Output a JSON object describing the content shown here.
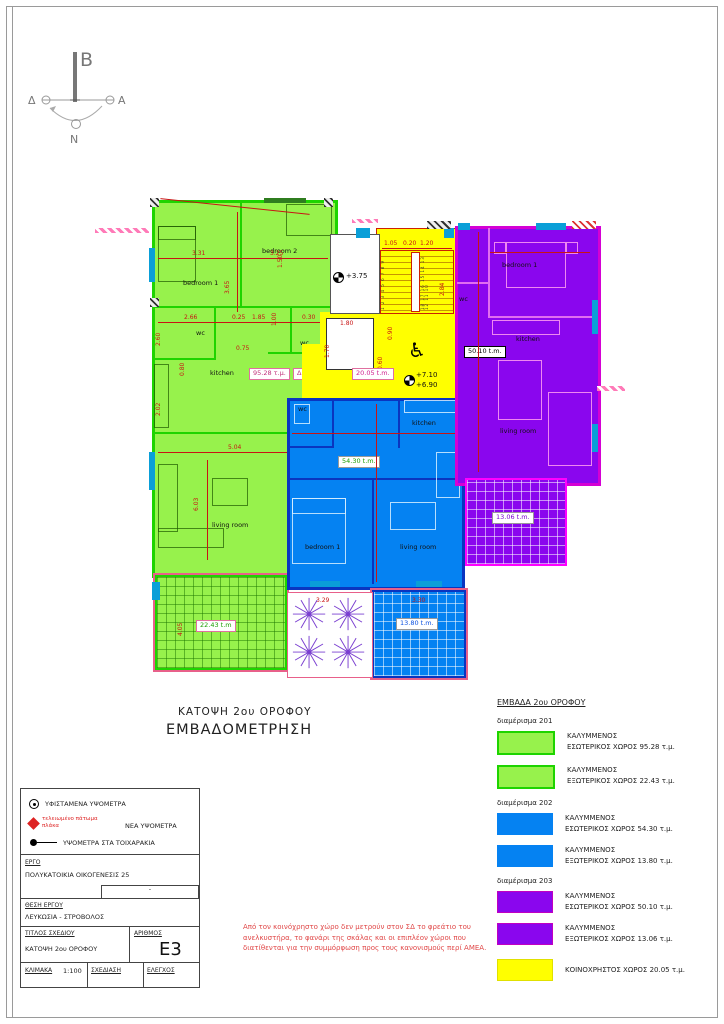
{
  "compass": {
    "north": "B",
    "east": "A",
    "west": "Δ",
    "south": "N"
  },
  "titles": {
    "line1": "ΚΑΤΟΨΗ  2ου ΟΡΟΦΟΥ",
    "line2": "ΕΜΒΑΔΟΜΕΤΡΗΣΗ"
  },
  "icons": {
    "wheelchair": "♿"
  },
  "plan": {
    "apt201": {
      "tag": "ΔΙΑΜ 201",
      "area_box": "95.28 τ.μ.",
      "balcony": "22.43 t.m",
      "bedroom1": "bedroom 1",
      "bedroom2": "bedroom 2",
      "wc1": "wc",
      "wc2": "wc",
      "kitchen": "kitchen",
      "living": "living room"
    },
    "apt202": {
      "area_box": "54.30 t.m.",
      "balcony": "13.80 t.m.",
      "wc": "wc",
      "kitchen": "kitchen",
      "bedroom1": "bedroom 1",
      "living": "living room"
    },
    "apt203": {
      "area_box": "50.10 t.m.",
      "balcony": "13.06 t.m.",
      "wc": "wc",
      "kitchen": "kitchen",
      "bedroom1": "bedroom 1",
      "living": "living room"
    },
    "common": {
      "area_box": "20.05 t.m.",
      "level_existing": "+3.75",
      "level_new1": "+7.10",
      "level_new2": "+6.90",
      "stairs_left": "1 2 3 4 5 6 7 8 9",
      "stairs_right": "18 17 16 15 14 13 12 11 10"
    },
    "dims": {
      "d1": "3.31",
      "d2": "3.25",
      "d3": "3.65",
      "d4": "1.50",
      "d5": "2.66",
      "d6": "0.25",
      "d7": "1.85",
      "d8": "1.00",
      "d9": "0.30",
      "d10": "0.80",
      "d11": "5.04",
      "d12": "6.03",
      "d13": "4.05",
      "d14": "2.02",
      "d15": "2.60",
      "d16": "1.05",
      "d17": "0.20",
      "d18": "1.20",
      "d19": "2.84",
      "d20": "0.90",
      "d21": "0.60",
      "d22": "1.80",
      "d23": "1.70",
      "d24": "3.29",
      "d25": "3.30",
      "d26": "0.75"
    }
  },
  "legend": {
    "header": "ΕΜΒΑΔΑ 2ου ΟΡΟΦΟΥ",
    "groups": [
      {
        "label": "διαμέρισμα 201",
        "items": [
          {
            "line1": "ΚΑΛΥΜΜΕΝΟΣ",
            "line2": "ΕΣΩΤΕΡΙΚΟΣ ΧΩΡΟΣ  95.28 τ.μ."
          },
          {
            "line1": "ΚΑΛΥΜΜΕΝΟΣ",
            "line2": "ΕΞΩΤΕΡΙΚΟΣ ΧΩΡΟΣ  22.43 τ.μ."
          }
        ]
      },
      {
        "label": "διαμέρισμα 202",
        "items": [
          {
            "line1": "ΚΑΛΥΜΜΕΝΟΣ",
            "line2": "ΕΣΩΤΕΡΙΚΟΣ ΧΩΡΟΣ 54.30 τ.μ."
          },
          {
            "line1": "ΚΑΛΥΜΜΕΝΟΣ",
            "line2": "ΕΞΩΤΕΡΙΚΟΣ ΧΩΡΟΣ 13.80 τ.μ."
          }
        ]
      },
      {
        "label": "διαμέρισμα 203",
        "items": [
          {
            "line1": "ΚΑΛΥΜΜΕΝΟΣ",
            "line2": "ΕΣΩΤΕΡΙΚΟΣ ΧΩΡΟΣ  50.10 τ.μ."
          },
          {
            "line1": "ΚΑΛΥΜΜΕΝΟΣ",
            "line2": "ΕΞΩΤΕΡΙΚΟΣ ΧΩΡΟΣ 13.06 τ.μ."
          }
        ]
      }
    ],
    "common_item": "ΚΟΙΝΟΧΡΗΣΤΟΣ ΧΩΡΟΣ  20.05 τ.μ."
  },
  "symbols_key": {
    "item1": "ΥΦΙΣΤΑΜΕΝΑ ΥΨΟΜΕΤΡΑ",
    "item2_note1": "τελειωμένο πάτωμα",
    "item2_note2": "πλάκα",
    "item2": "ΝΕΑ ΥΨΟΜΕΤΡΑ",
    "item3": "ΥΨΟΜΕΤΡΑ ΣΤΑ ΤΟΙΧΑΡΑΚΙΑ"
  },
  "title_block": {
    "ergo_label": "ΕΡΓΟ",
    "ergo_value": "ΠΟΛΥΚΑΤΟΙΚΙΑ ΟΙΚΟΓΕΝΕΣΙΣ 25",
    "ergo_extra": "-",
    "location_label": "ΘΕΣΗ ΕΡΓΟΥ",
    "location_value": "ΛΕΥΚΩΣΙΑ - ΣΤΡΟΒΟΛΟΣ",
    "drawing_title_label": "ΤΙΤΛΟΣ ΣΧΕΔΙΟΥ",
    "drawing_title_value": "ΚΑΤΟΨΗ 2ου ΟΡΟΦΟΥ",
    "number_label": "ΑΡΙΘΜΟΣ",
    "number_value": "E3",
    "scale_label": "ΚΛΙΜΑΚΑ",
    "scale_value": "1:100",
    "draw_label": "ΣΧΕΔΙΑΣΗ",
    "check_label": "ΕΛΕΓΧΟΣ"
  },
  "note": {
    "text": "Από τον κοινόχρηστο χώρο δεν μετρούν στον ΣΔ το φρεάτιο του ανελκυστήρα, το φανάρι της σκάλας και οι επιπλέον χώροι που διατίθενται για την συμμόρφωση προς τους κανονισμούς περί ΑΜΕΑ."
  },
  "colors": {
    "apt201": "#97f24c",
    "apt201-border": "#1ed400",
    "apt202": "#0582f2",
    "apt202-wall": "#0a35c0",
    "apt203": "#8a06ee",
    "apt203-wall": "#d400d4",
    "common": "#ffff00",
    "window": "#0a9fd8",
    "dim": "#c81414",
    "note": "#e04848"
  }
}
